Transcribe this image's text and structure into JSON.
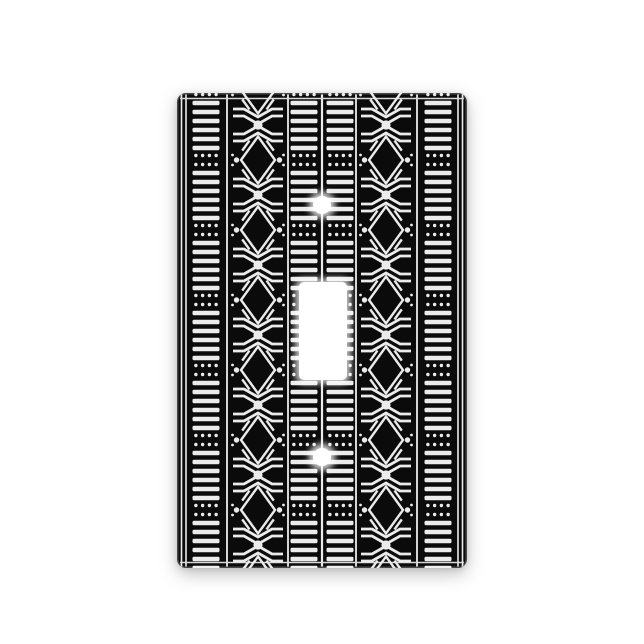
{
  "scene": {
    "alt_text": "Black and white African mudcloth patterned single toggle light switch cover plate photographed on a white background",
    "background_color": "#ffffff"
  },
  "plate": {
    "x": 177,
    "y": 93,
    "width": 290,
    "height": 475,
    "corner_radius": 9,
    "base_color": "#0b0b0b",
    "bevel_highlight": "rgba(255,255,255,0.25)"
  },
  "toggle_hole": {
    "x": 122,
    "y": 189,
    "width": 48,
    "height": 98,
    "corner_radius": 5,
    "color": "#ffffff"
  },
  "screw_holes": [
    {
      "cx": 145,
      "cy": 112,
      "r": 9
    },
    {
      "cx": 145,
      "cy": 364,
      "r": 9
    }
  ],
  "pattern": {
    "color": "#ebebeb",
    "unit_period": 70,
    "unit_phase": 67,
    "horizontal_edge_lines": {
      "ys": [
        5.5,
        469.5
      ],
      "stroke_width": 1.5,
      "color": "#d8d8d8"
    },
    "vertical_lines": [
      {
        "x": 4.5,
        "w": 1.6
      },
      {
        "x": 9,
        "w": 1.6
      },
      {
        "x": 50,
        "w": 1.8
      },
      {
        "x": 111,
        "w": 1.8
      },
      {
        "x": 145,
        "w": 2.2
      },
      {
        "x": 179,
        "w": 1.8
      },
      {
        "x": 240,
        "w": 1.8
      },
      {
        "x": 281,
        "w": 1.6
      },
      {
        "x": 285.5,
        "w": 1.6
      }
    ],
    "dash_columns": {
      "centers": [
        29,
        127,
        163,
        261
      ],
      "width": 27,
      "dash_height": 4.4,
      "dash_pitch": 9,
      "dash_count": 6,
      "first_dash_offset": 13,
      "cluster": {
        "rows_offset": 4.5,
        "dots_per_row": 4,
        "dot_radius": 1.7,
        "dot_spacing": 6.75
      }
    },
    "diamond_columns": {
      "centers": [
        81,
        209
      ],
      "half_width": 25,
      "diamond": {
        "outline_half_w": 17,
        "outline_half_h": 23.5,
        "outline_stroke": 2.4
      },
      "side_dot": {
        "dx": 21.5,
        "r": 2.7
      },
      "edge_dots": {
        "dx": 25.5,
        "dy": 5,
        "r": 1.4
      },
      "corner_tick": {
        "offset": 4.5,
        "half_len": 6.2,
        "stroke": 2.4
      },
      "chevrons": {
        "stroke": 2.8,
        "elbow": 14,
        "pairs": [
          [
            19,
            27
          ],
          [
            26,
            34
          ]
        ]
      },
      "center_dot": {
        "dy": 35,
        "r": 4.6
      }
    }
  }
}
